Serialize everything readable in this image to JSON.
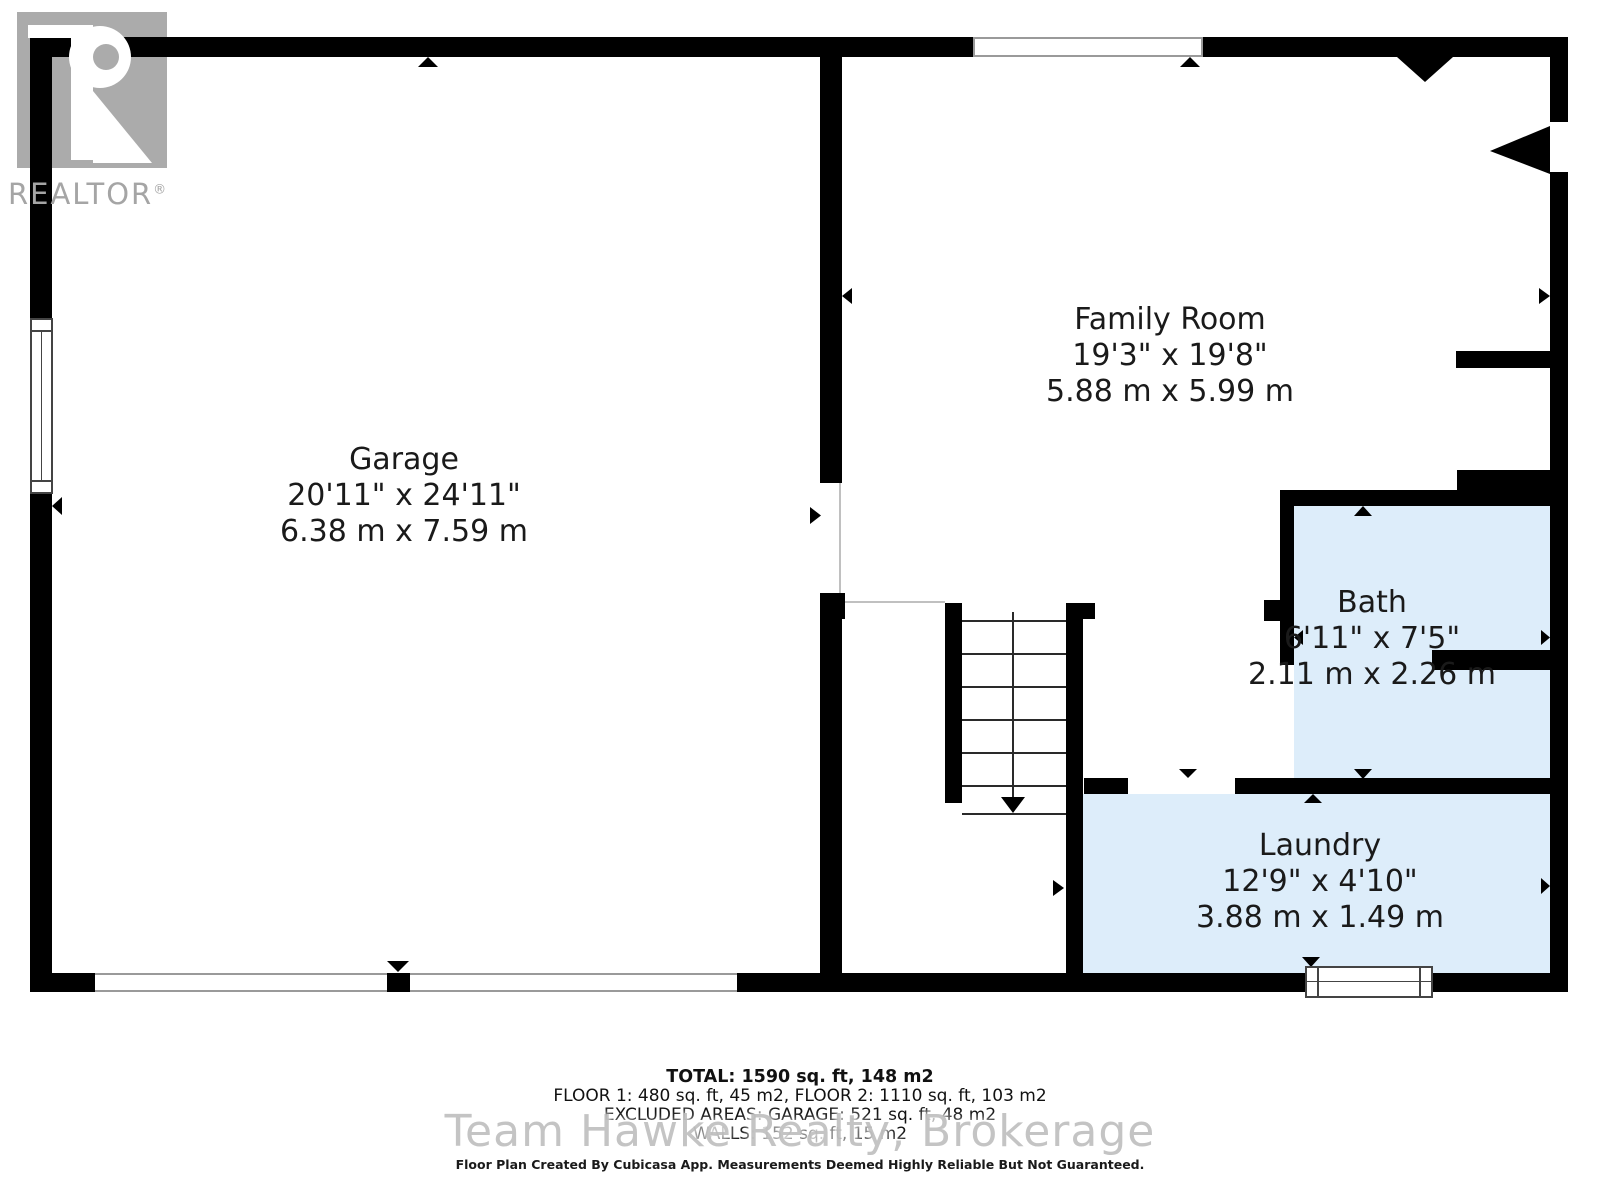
{
  "logo": {
    "text": "REALTOR",
    "registered": "®"
  },
  "rooms": {
    "garage": {
      "name": "Garage",
      "imperial": "20'11\" x 24'11\"",
      "metric": "6.38 m x 7.59 m"
    },
    "family": {
      "name": "Family Room",
      "imperial": "19'3\" x 19'8\"",
      "metric": "5.88 m x 5.99 m"
    },
    "bath": {
      "name": "Bath",
      "imperial": "6'11\" x 7'5\"",
      "metric": "2.11 m x 2.26 m"
    },
    "laundry": {
      "name": "Laundry",
      "imperial": "12'9\" x 4'10\"",
      "metric": "3.88 m x 1.49 m"
    }
  },
  "summary": {
    "total": "TOTAL: 1590 sq. ft, 148 m2",
    "floors": "FLOOR 1: 480 sq. ft, 45 m2, FLOOR 2: 1110 sq. ft, 103 m2",
    "excluded": "EXCLUDED AREAS: GARAGE: 521 sq. ft, 48 m2",
    "walls": "WALLS: 152 sq. ft, 15 m2"
  },
  "watermark": "Team Hawke Realty, Brokerage",
  "disclaimer": "Floor Plan Created By Cubicasa App. Measurements Deemed Highly Reliable But Not Guaranteed.",
  "colors": {
    "wall": "#000000",
    "room_fill": "#ddedfa",
    "logo_gray": "#ababab",
    "watermark_gray": "#bababa"
  }
}
